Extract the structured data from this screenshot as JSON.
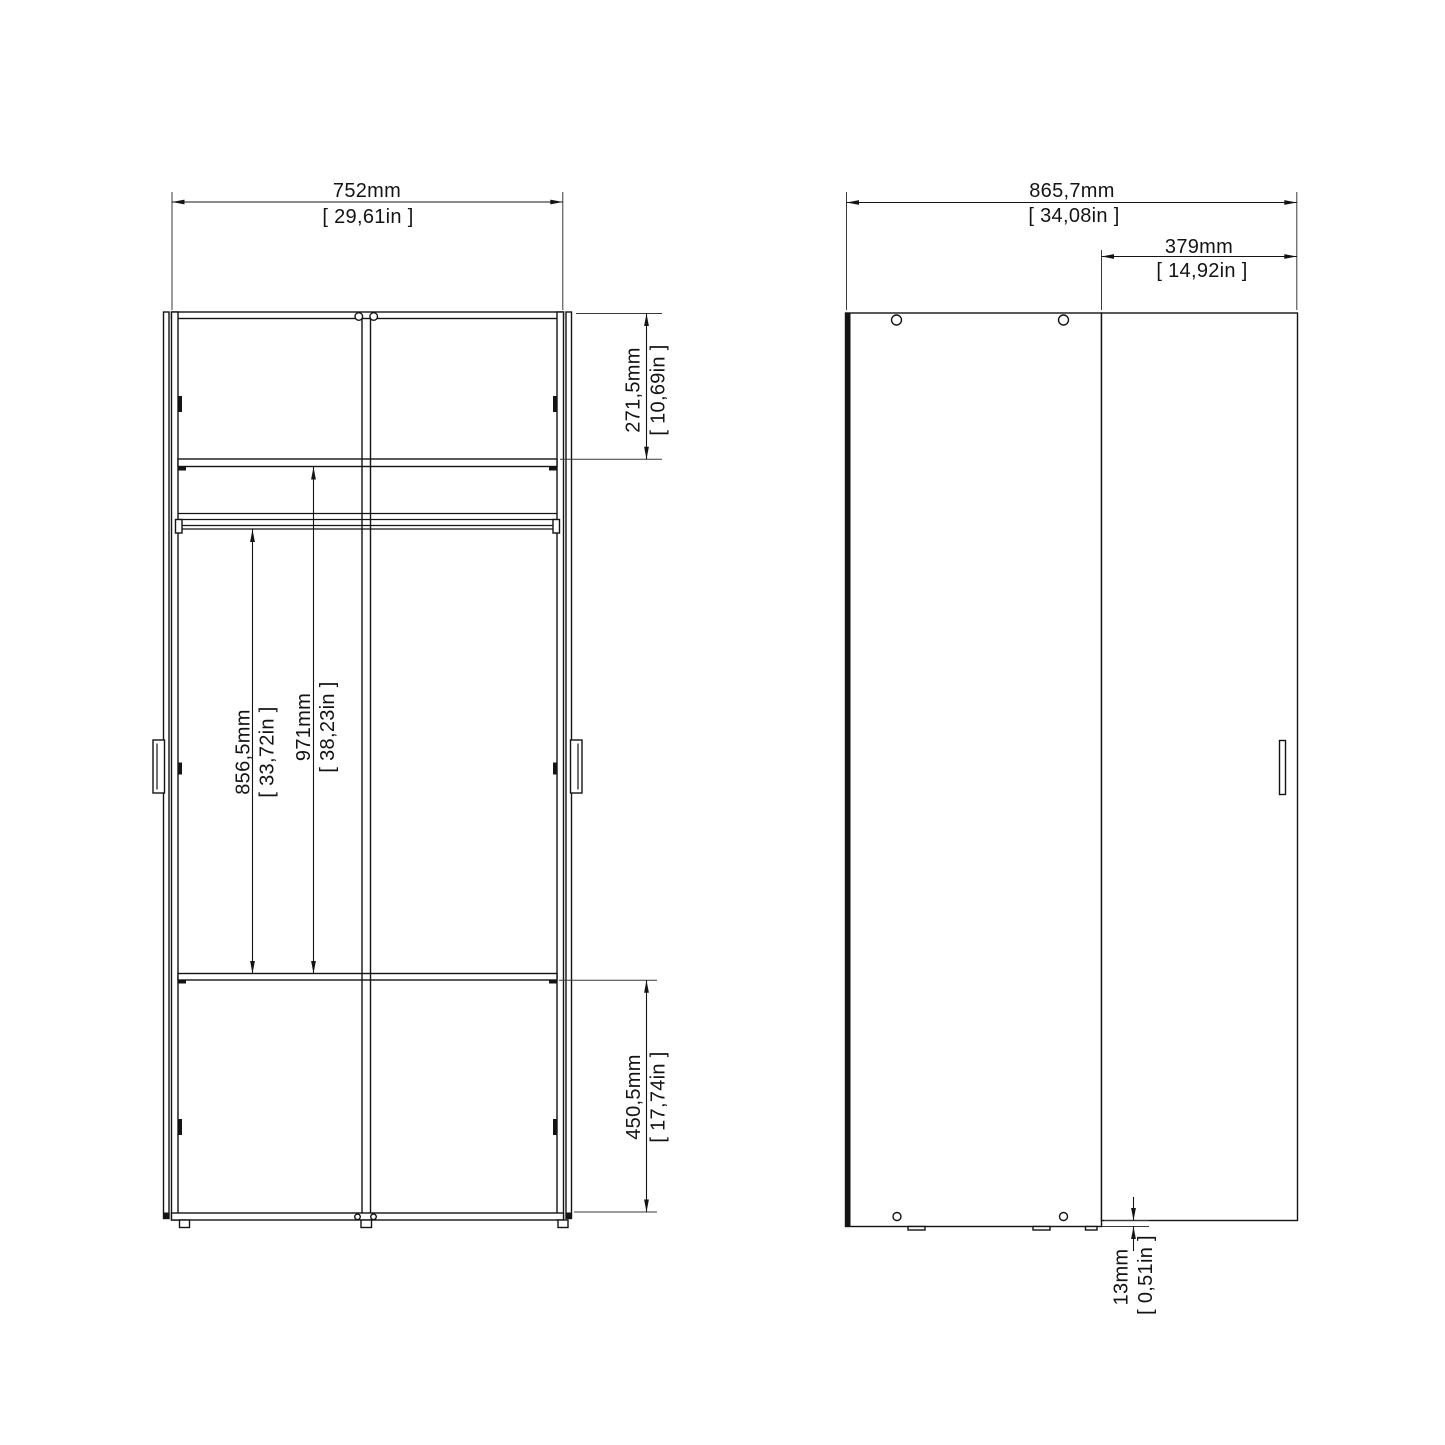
{
  "front_view": {
    "width": {
      "mm": "752mm",
      "in": "[ 29,61in ]"
    },
    "top_section": {
      "mm": "271,5mm",
      "in": "[ 10,69in ]"
    },
    "rail_height": {
      "mm": "856,5mm",
      "in": "[ 33,72in ]"
    },
    "interior_height": {
      "mm": "971mm",
      "in": "[ 38,23in ]"
    },
    "bottom_section": {
      "mm": "450,5mm",
      "in": "[ 17,74in ]"
    }
  },
  "side_view": {
    "total_depth": {
      "mm": "865,7mm",
      "in": "[ 34,08in ]"
    },
    "door_width": {
      "mm": "379mm",
      "in": "[ 14,92in ]"
    },
    "door_thickness": {
      "mm": "13mm",
      "in": "[ 0,51in ]"
    }
  }
}
